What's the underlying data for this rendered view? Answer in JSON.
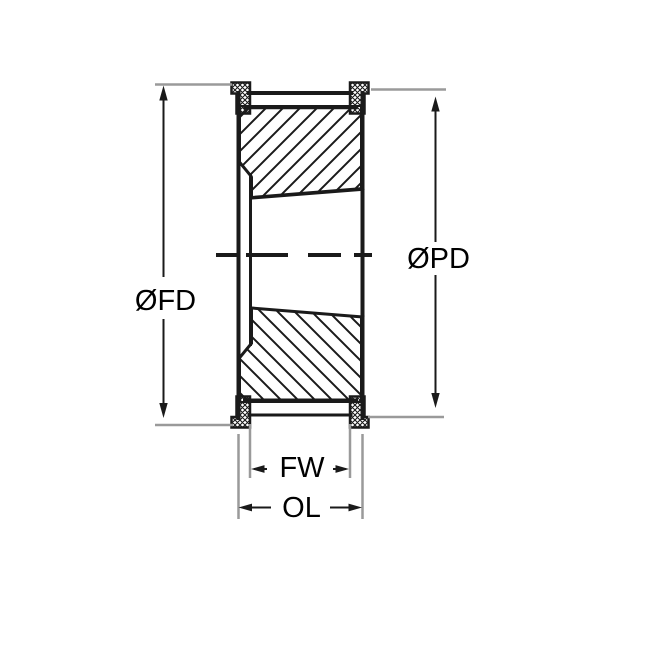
{
  "drawing": {
    "type": "pulley-cross-section-technical-drawing",
    "labels": {
      "flange_diameter": "ØFD",
      "pitch_diameter": "ØPD",
      "face_width": "FW",
      "overall_length": "OL"
    }
  },
  "colors": {
    "background": "#ffffff",
    "line": "#1a1a1a",
    "extension": "#9a9a9a",
    "text": "#000000"
  }
}
